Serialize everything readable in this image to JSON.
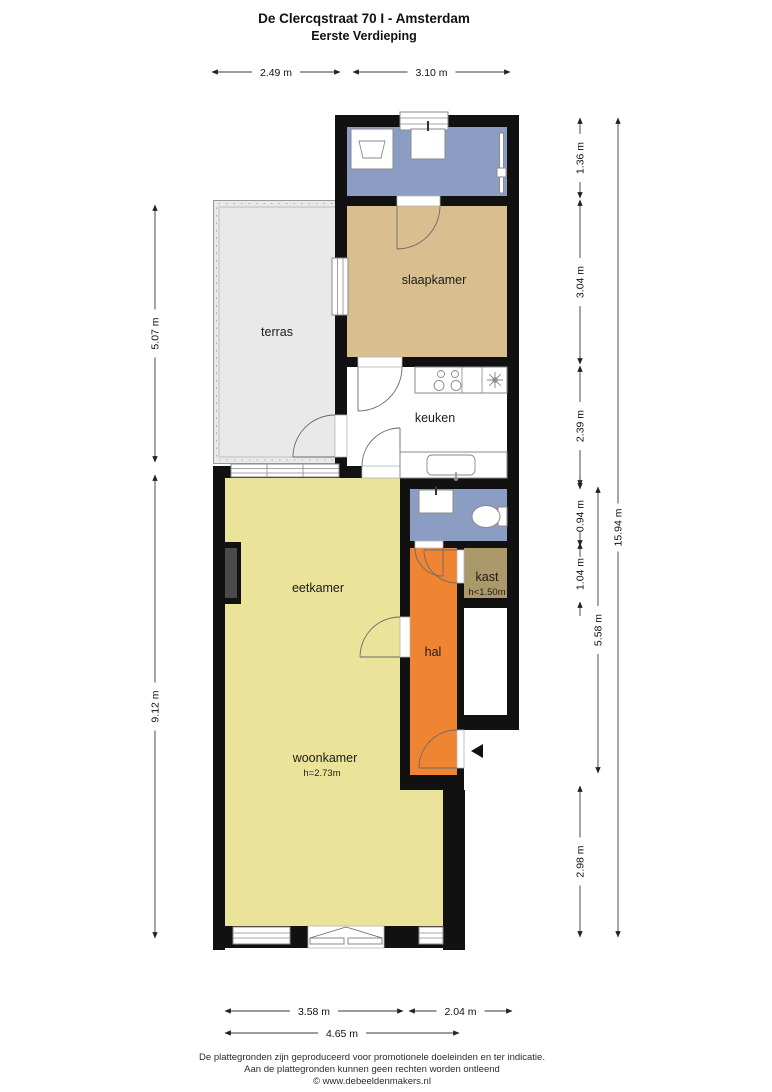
{
  "title": {
    "line1": "De Clercqstraat 70 I - Amsterdam",
    "line2": "Eerste Verdieping"
  },
  "rooms": {
    "terras": {
      "label": "terras"
    },
    "slaapkamer": {
      "label": "slaapkamer"
    },
    "keuken": {
      "label": "keuken"
    },
    "eetkamer": {
      "label": "eetkamer"
    },
    "woonkamer": {
      "label": "woonkamer",
      "height_note": "h=2.73m"
    },
    "hal": {
      "label": "hal"
    },
    "kast": {
      "label": "kast",
      "height_note": "h<1.50m"
    }
  },
  "dimensions": {
    "top": [
      "2.49 m",
      "3.10 m"
    ],
    "left": [
      "5.07 m",
      "9.12 m"
    ],
    "right": [
      "1.36 m",
      "3.04 m",
      "2.39 m",
      "0.94 m",
      "1.04 m",
      "5.58 m",
      "2.98 m",
      "15.94 m"
    ],
    "bottom": [
      "3.58 m",
      "2.04 m",
      "4.65 m"
    ]
  },
  "footer": {
    "line1": "De plattegronden zijn geproduceerd voor promotionele doeleinden en ter indicatie.",
    "line2": "Aan de plattegronden kunnen geen rechten worden ontleend",
    "line3": "© www.debeeldenmakers.nl"
  },
  "colors": {
    "wall": "#111111",
    "bathroom_floor": "#8b9dc3",
    "toilet_floor": "#8b9dc3",
    "bedroom_floor": "#d9be90",
    "terrace_floor": "#e9e9e9",
    "kitchen_floor": "#ffffff",
    "living_floor": "#ece39a",
    "hall_floor": "#ef8532",
    "closet_floor": "#ab996a",
    "stairwell_floor": "#ffffff",
    "chimney": "#4a4a4a"
  }
}
